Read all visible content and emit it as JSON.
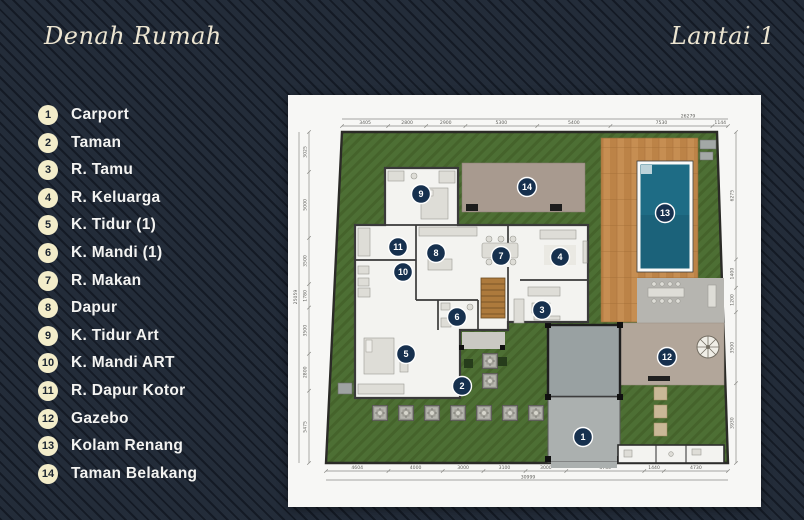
{
  "header": {
    "title_left": "Denah Rumah",
    "title_right": "Lantai 1",
    "title_color": "#ece5d1"
  },
  "background": {
    "base_color": "#232c39",
    "stripe_color": "#1a212c"
  },
  "legend": {
    "badge_color": "#f3edca",
    "badge_text_color": "#1c2531",
    "label_color": "#f3f3f1",
    "items": [
      {
        "num": "1",
        "label": "Carport"
      },
      {
        "num": "2",
        "label": "Taman"
      },
      {
        "num": "3",
        "label": "R. Tamu"
      },
      {
        "num": "4",
        "label": "R. Keluarga"
      },
      {
        "num": "5",
        "label": "K. Tidur (1)"
      },
      {
        "num": "6",
        "label": "K. Mandi (1)"
      },
      {
        "num": "7",
        "label": "R. Makan"
      },
      {
        "num": "8",
        "label": "Dapur"
      },
      {
        "num": "9",
        "label": "K. Tidur Art"
      },
      {
        "num": "10",
        "label": "K. Mandi ART"
      },
      {
        "num": "11",
        "label": "R. Dapur Kotor"
      },
      {
        "num": "12",
        "label": "Gazebo"
      },
      {
        "num": "13",
        "label": "Kolam Renang"
      },
      {
        "num": "14",
        "label": "Taman Belakang"
      }
    ]
  },
  "plan": {
    "marker_color": "#16304e",
    "marker_ring_color": "#ffffff",
    "marker_text_color": "#ffffff",
    "colors": {
      "grass": "#4d6f34",
      "grass_hatch": "#45632b",
      "wood_deck": "#c68e52",
      "pool_water": "#1e6c85",
      "patio": "#a89a8f",
      "walkway": "#b6b5b0",
      "gazebo_floor": "#b2a69a",
      "garage": "#99a1a2",
      "carport": "#abb0af",
      "room_floor": "#f3f3f0",
      "wall": "#3a3a3a",
      "stair_wood": "#ad7a3c"
    },
    "markers": [
      {
        "num": "1",
        "x": 295,
        "y": 342
      },
      {
        "num": "2",
        "x": 174,
        "y": 291
      },
      {
        "num": "3",
        "x": 254,
        "y": 215
      },
      {
        "num": "4",
        "x": 272,
        "y": 162
      },
      {
        "num": "5",
        "x": 118,
        "y": 259
      },
      {
        "num": "6",
        "x": 169,
        "y": 222
      },
      {
        "num": "7",
        "x": 213,
        "y": 161
      },
      {
        "num": "8",
        "x": 148,
        "y": 158
      },
      {
        "num": "9",
        "x": 133,
        "y": 99
      },
      {
        "num": "10",
        "x": 115,
        "y": 177
      },
      {
        "num": "11",
        "x": 110,
        "y": 152
      },
      {
        "num": "12",
        "x": 379,
        "y": 262
      },
      {
        "num": "13",
        "x": 377,
        "y": 118
      },
      {
        "num": "14",
        "x": 239,
        "y": 92
      }
    ],
    "dimensions": {
      "top": {
        "overall": "26279",
        "segments": [
          "3405",
          "2800",
          "2900",
          "5300",
          "5400",
          "7530",
          "1144"
        ]
      },
      "bottom": {
        "overall": "30999",
        "segments": [
          "4604",
          "4000",
          "3000",
          "3100",
          "3000",
          "5750",
          "1440",
          "4730"
        ]
      },
      "left": {
        "overall": "25059",
        "segments": [
          "3025",
          "5000",
          "3500",
          "1780",
          "3500",
          "2800",
          "5475"
        ]
      },
      "right": {
        "segments": [
          "6275",
          "1400",
          "1200",
          "3500",
          "3930"
        ]
      }
    }
  }
}
